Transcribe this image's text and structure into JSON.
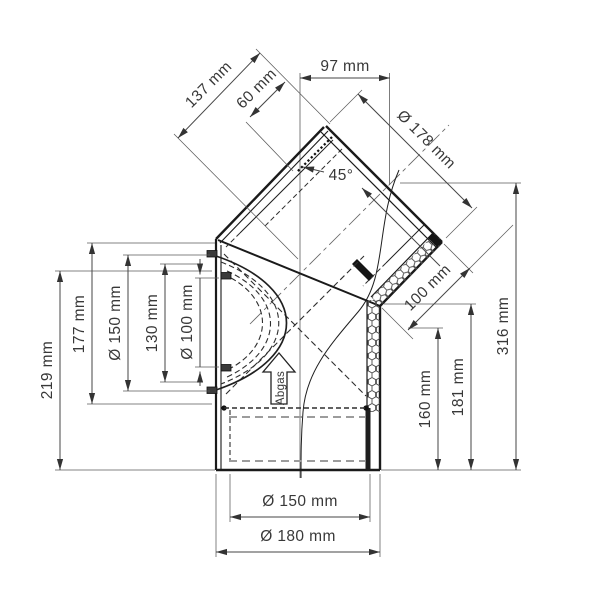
{
  "dims": {
    "d137": "137 mm",
    "d60": "60 mm",
    "d97": "97 mm",
    "d178": "Ø 178 mm",
    "angle": "45°",
    "d100": "100 mm",
    "d219": "219 mm",
    "d177": "177 mm",
    "d150_left": "Ø 150 mm",
    "d130": "130 mm",
    "d100_left": "Ø 100 mm",
    "d160": "160 mm",
    "d181": "181 mm",
    "d316": "316 mm",
    "d150_bottom": "Ø 150 mm",
    "d180_bottom": "Ø 180 mm",
    "flow": "Abgas"
  },
  "colors": {
    "object_line": "#1a1a1a",
    "dimension_line": "#464646",
    "text": "#383838",
    "hidden_gray_dash": "#9c9c9c",
    "background": "#ffffff"
  }
}
